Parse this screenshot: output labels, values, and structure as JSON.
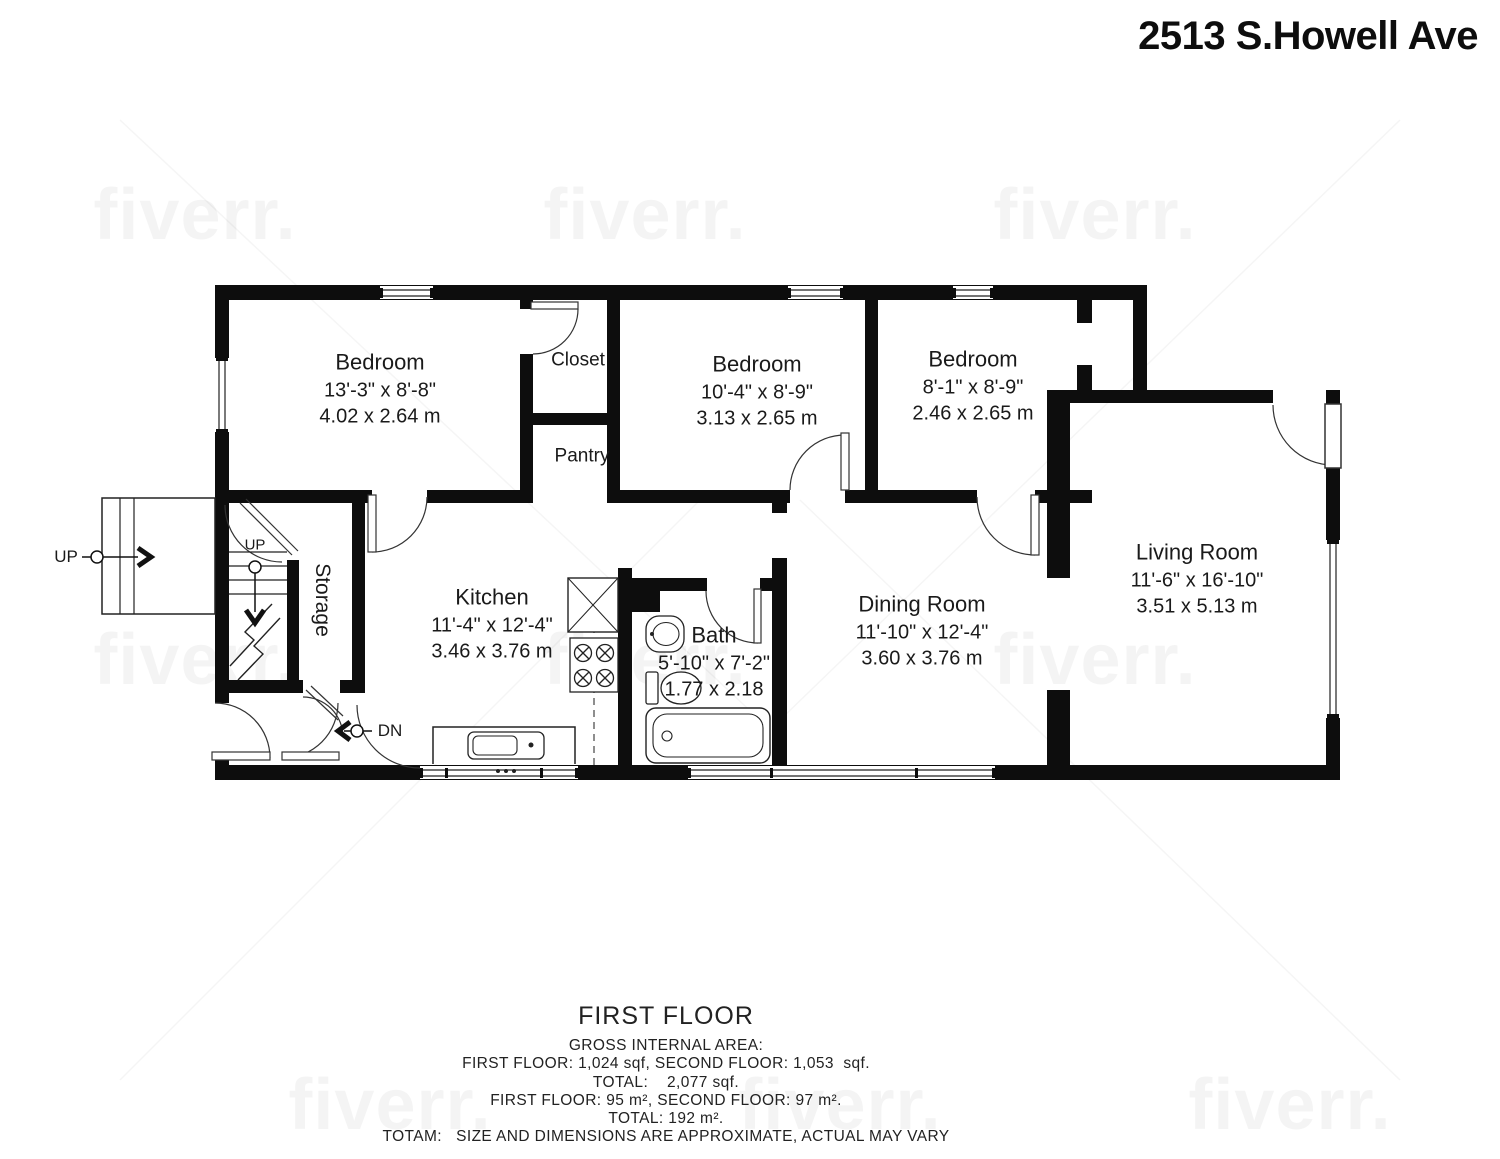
{
  "title": "2513 S.Howell Ave",
  "rooms": [
    {
      "name": "Bedroom",
      "imperial": "13'-3\" x 8'-8\"",
      "metric": "4.02 x 2.64 m"
    },
    {
      "name": "Closet"
    },
    {
      "name": "Pantry"
    },
    {
      "name": "Bedroom",
      "imperial": "10'-4\" x 8'-9\"",
      "metric": "3.13 x 2.65 m"
    },
    {
      "name": "Bedroom",
      "imperial": "8'-1\" x 8'-9\"",
      "metric": "2.46 x 2.65 m"
    },
    {
      "name": "Living Room",
      "imperial": "11'-6\" x 16'-10\"",
      "metric": "3.51 x 5.13 m"
    },
    {
      "name": "Kitchen",
      "imperial": "11'-4\" x 12'-4\"",
      "metric": "3.46 x 3.76 m"
    },
    {
      "name": "Bath",
      "imperial": "5'-10\" x 7'-2\"",
      "metric": "1.77 x 2.18"
    },
    {
      "name": "Dining Room",
      "imperial": "11'-10\" x 12'-4\"",
      "metric": "3.60 x 3.76 m"
    },
    {
      "name": "Storage"
    }
  ],
  "annotations": {
    "up_outside": "UP",
    "up_stairs": "UP",
    "down": "DN"
  },
  "footer": {
    "floor_title": "FIRST FLOOR",
    "line1": "GROSS INTERNAL AREA:",
    "line2": "FIRST FLOOR: 1,024 sqf, SECOND FLOOR: 1,053  sqf.",
    "line3": "TOTAL:    2,077 sqf.",
    "line4": "FIRST FLOOR: 95 m², SECOND FLOOR: 97 m².",
    "line5": "TOTAL: 192 m².",
    "line6": "TOTAM:   SIZE AND DIMENSIONS ARE APPROXIMATE, ACTUAL MAY VARY"
  },
  "watermark": "fiverr.",
  "colors": {
    "wall": "#0d0d0d",
    "line": "#222222",
    "watermark_text": "rgba(0,0,0,0.045)"
  }
}
